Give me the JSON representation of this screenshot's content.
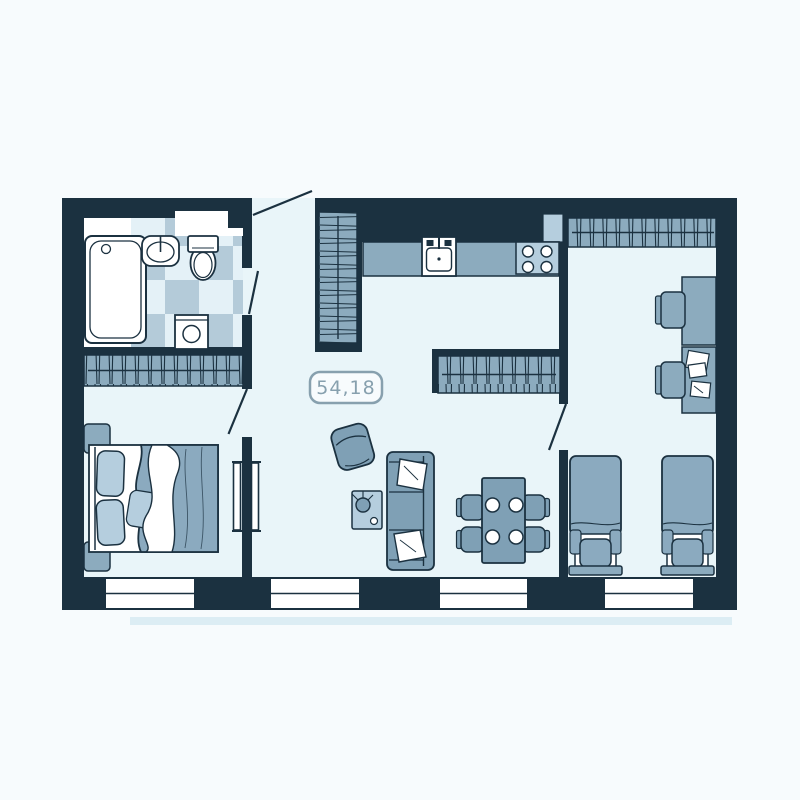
{
  "plan": {
    "area_label": "54,18"
  },
  "rooms": {
    "bathroom": {
      "furniture": [
        "bathtub-symbol",
        "washbasin-symbol",
        "toilet-symbol",
        "washing-machine-symbol",
        "checker-tile-floor",
        "wall-niche"
      ]
    },
    "bedroom_left": {
      "furniture": [
        "wardrobe-hatched",
        "double-bed-symbol",
        "nightstand",
        "nightstand",
        "pillows",
        "blanket",
        "sliding-door-symbol"
      ]
    },
    "hallway": {
      "furniture": [
        "tall-wardrobe-hatched",
        "entrance-door-swing",
        "bathroom-door-swing",
        "bedroom-door-swing"
      ]
    },
    "kitchen_living": {
      "furniture": [
        "kitchen-counter",
        "kitchen-sink-symbol",
        "stove-4-burners",
        "vent-duct",
        "center-wardrobe-hatched",
        "armchair-symbol",
        "coffee-table-with-plant",
        "sofa-symbol",
        "sofa-pillows",
        "dining-table-symbol",
        "dining-chairs",
        "plates"
      ]
    },
    "bedroom_right": {
      "furniture": [
        "wardrobe-hatched",
        "desk",
        "desk",
        "desk-chair",
        "desk-chair",
        "papers",
        "single-bed-symbol",
        "single-bed-symbol",
        "room-door-swing"
      ]
    },
    "exterior": {
      "windows_count": 4
    }
  },
  "colors": {
    "page": "#f7fbfd",
    "wall": "#1b3140",
    "floor": "#e9f5f9",
    "white": "#ffffff",
    "mid": "#7fa0b5",
    "ward": "#8cabbe",
    "lite": "#b5cede",
    "bed": "#8baabf",
    "tileA": "#b4cbd9",
    "tileB": "#e4f1f7",
    "label": "#87a0ae",
    "shadow": "#dcedf4"
  }
}
